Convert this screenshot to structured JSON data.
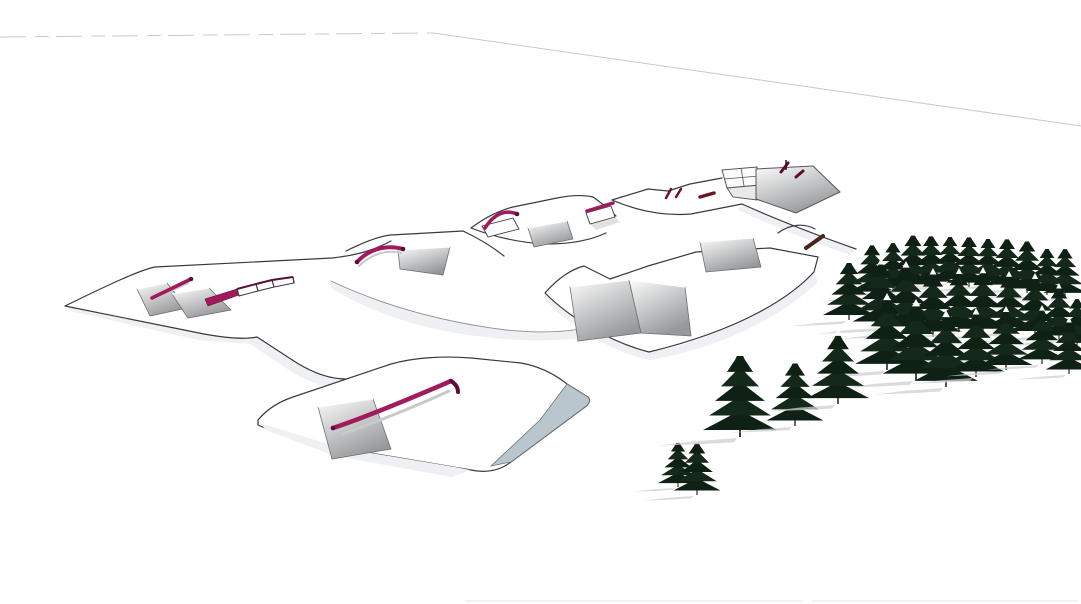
{
  "scene": {
    "kind": "3d-terrain-park-render",
    "canvas": {
      "width": 1081,
      "height": 604
    },
    "palette": {
      "background": "#ffffff",
      "terrain_line": "#3a3a3e",
      "soft_line": "#8f8f94",
      "horizon_line": "#c7cacd",
      "slope_shade": "#eef0f3",
      "ramp_light": "#fcfcfc",
      "ramp_dark": "#96989a",
      "ramp_stroke": "#6f7072",
      "rail_magenta": "#a01a5c",
      "rail_dark": "#5d0c36",
      "rail_shadow": "#c9c9cc",
      "blue_face": "#b9c6ce",
      "blue_face_stroke": "#6b747a",
      "box_white": "#fdfdfd",
      "tree_green": "#14291a",
      "tree_green_dark": "#0f2114",
      "tree_trunk": "#1c1c1c",
      "tree_shadow": "#cfcfd2",
      "jib_red": "#6b1426",
      "brown_rail": "#4b241c",
      "bottom_dash": "#ededef"
    },
    "horizon": {
      "left_segment": "M0,37 L433,33",
      "right_segment": "M433,33 L1081,126",
      "left_dash": "26 9 14 7"
    },
    "bottom_marks": [
      "M465,601 L803,601",
      "M812,601 L1078,601"
    ],
    "shades": [
      {
        "name": "shade-mound1-front",
        "d": "M65,306 L204,334 C232,339 248,339 257,337 L297,363 C315,374 331,379 346,379 L338,388 C318,386 300,378 286,368 L250,344 L198,340 L70,311 Z"
      },
      {
        "name": "shade-central-slope",
        "d": "M331,281 C382,305 442,322 506,330 C546,334 580,332 606,322 L606,334 C560,344 500,342 440,330 C390,320 350,300 331,288 Z"
      },
      {
        "name": "shade-crm-front",
        "d": "M545,293 C570,318 610,342 649,352 C700,345 770,312 814,272 L818,282 C780,318 720,348 650,360 C610,352 570,326 545,300 Z"
      },
      {
        "name": "shade-t4-right",
        "d": "M742,204 C780,221 822,237 856,249 L850,255 C815,243 775,227 738,210 Z"
      }
    ],
    "closed_terrain": [
      {
        "name": "center-right-mound",
        "d": "M545,293 C558,278 572,269 584,266 L610,279 L648,266 L696,252 L770,248 L818,257 L814,272 C790,298 740,330 649,352 C610,342 570,318 545,293 Z"
      },
      {
        "name": "bottom-plateau",
        "d": "M258,420 C268,408 281,401 293,397 L391,364 C416,357 446,356 471,358 L521,363 C543,367 557,376 567,384 L588,397 C591,400 589,404 585,407 L511,462 C499,471 485,473 471,470 L341,448 C301,440 271,431 258,425 Z"
      }
    ],
    "plateau_extras": {
      "blue_face": "M567,384 L588,397 C591,400 589,404 585,407 L511,462 L491,466 L540,420 Z",
      "front_shade": "M260,423 L341,448 L455,467 L470,470 L452,477 L335,456 L266,430 Z"
    },
    "edges": [
      {
        "name": "edge-mound1-back",
        "d": "M65,306 C110,284 140,270 155,267 L332,258 C360,255 376,249 391,241",
        "soft": false
      },
      {
        "name": "edge-mound1-base",
        "d": "M65,306 L204,334 C232,339 248,339 257,337 L297,363 C315,374 331,379 346,379",
        "soft": false
      },
      {
        "name": "edge-t2-back",
        "d": "M346,251 C366,241 380,236 391,235 L463,231",
        "soft": false
      },
      {
        "name": "edge-t2-right",
        "d": "M463,231 C480,239 494,248 504,256",
        "soft": false
      },
      {
        "name": "edge-mid-break",
        "d": "M331,281 C382,305 442,322 506,330 C546,334 580,332 606,322",
        "soft": true
      },
      {
        "name": "edge-t3-back",
        "d": "M471,228 C487,216 501,210 513,207 L557,198 C572,195 584,195 593,197",
        "soft": false
      },
      {
        "name": "edge-t3-right",
        "d": "M593,197 C603,204 611,211 616,216",
        "soft": false
      },
      {
        "name": "edge-t3-front",
        "d": "M471,228 C497,238 522,243 547,244 C572,244 591,240 606,233",
        "soft": false
      },
      {
        "name": "edge-t4-ridge",
        "d": "M612,200 L648,189 L668,191 L690,184 L722,178",
        "soft": false
      },
      {
        "name": "edge-t4-front",
        "d": "M612,200 C640,212 666,216 691,214 L742,204",
        "soft": false
      },
      {
        "name": "edge-t4-right",
        "d": "M742,204 C780,221 822,237 856,249",
        "soft": false
      },
      {
        "name": "edge-behind-trees",
        "d": "M778,233 C790,224 804,223 815,229",
        "soft": false
      }
    ],
    "ramps": [
      {
        "name": "kicker-left-1",
        "points": [
          [
            137,
            289
          ],
          [
            167,
            283
          ],
          [
            187,
            308
          ],
          [
            150,
            316
          ]
        ]
      },
      {
        "name": "kicker-left-2",
        "points": [
          [
            172,
            294
          ],
          [
            209,
            288
          ],
          [
            231,
            310
          ],
          [
            188,
            318
          ]
        ]
      },
      {
        "name": "pit-terrace2",
        "points": [
          [
            398,
            250
          ],
          [
            450,
            247
          ],
          [
            443,
            275
          ],
          [
            400,
            269
          ]
        ]
      },
      {
        "name": "face-terrace3",
        "points": [
          [
            528,
            228
          ],
          [
            567,
            221
          ],
          [
            573,
            239
          ],
          [
            534,
            247
          ]
        ]
      },
      {
        "name": "panel-crm-top",
        "points": [
          [
            700,
            242
          ],
          [
            753,
            238
          ],
          [
            761,
            267
          ],
          [
            706,
            272
          ]
        ]
      },
      {
        "name": "panel-crm-a",
        "points": [
          [
            570,
            287
          ],
          [
            629,
            280
          ],
          [
            641,
            333
          ],
          [
            578,
            341
          ]
        ]
      },
      {
        "name": "panel-crm-b",
        "points": [
          [
            629,
            280
          ],
          [
            685,
            287
          ],
          [
            691,
            336
          ],
          [
            641,
            333
          ]
        ]
      },
      {
        "name": "kicker-plateau",
        "points": [
          [
            318,
            407
          ],
          [
            373,
            399
          ],
          [
            391,
            449
          ],
          [
            332,
            459
          ]
        ]
      }
    ],
    "boxes": [
      {
        "name": "jib-box-1",
        "points": [
          [
            482,
            226
          ],
          [
            513,
            218
          ],
          [
            519,
            229
          ],
          [
            488,
            237
          ]
        ]
      },
      {
        "name": "jib-box-2",
        "points": [
          [
            586,
            213
          ],
          [
            611,
            206
          ],
          [
            615,
            217
          ],
          [
            590,
            224
          ]
        ]
      }
    ],
    "box_shadows": [
      {
        "name": "jib-box-2-shadow",
        "points": [
          [
            590,
            224
          ],
          [
            615,
            217
          ],
          [
            620,
            222
          ],
          [
            596,
            230
          ]
        ]
      }
    ],
    "rail_shadows": [
      {
        "d": "M150,301 L188,283",
        "w": 2
      },
      {
        "d": "M359,266 C370,255 386,249 401,253",
        "w": 2
      },
      {
        "d": "M342,434 C385,419 425,402 449,391",
        "w": 3
      }
    ],
    "rails": [
      {
        "name": "rail-straight-left",
        "d": "M152,298 L191,279",
        "w": 3.5,
        "caps": [
          [
            191,
            279
          ]
        ]
      },
      {
        "name": "rail-rainbow",
        "d": "M357,262 C368,250 385,244 403,249",
        "w": 4,
        "caps": [
          [
            357,
            262
          ],
          [
            403,
            249
          ]
        ]
      },
      {
        "name": "rail-box-1",
        "d": "M485,228 C494,214 505,209 517,214",
        "w": 3.5,
        "caps": [
          [
            517,
            214
          ]
        ]
      },
      {
        "name": "rail-box-2",
        "d": "M587,211 L613,203",
        "w": 3.5,
        "caps": []
      },
      {
        "name": "rail-plateau-long",
        "d": "M333,428 C360,419 400,403 451,381",
        "w": 4.5,
        "caps": [
          [
            333,
            428
          ]
        ]
      },
      {
        "name": "rail-plateau-hook",
        "d": "M451,381 C456,384 458,388 458,392",
        "w": 4,
        "caps": [],
        "dark": true
      }
    ],
    "fence": {
      "solid": [
        [
          205,
          299
        ],
        [
          237,
          289
        ],
        [
          239,
          295
        ],
        [
          208,
          306
        ]
      ],
      "top": [
        [
          237,
          289
        ],
        [
          256,
          284
        ],
        [
          272,
          280
        ],
        [
          293,
          277
        ]
      ],
      "bottom": [
        [
          239,
          296
        ],
        [
          258,
          291
        ],
        [
          274,
          287
        ],
        [
          294,
          283
        ]
      ]
    },
    "funbox": {
      "grid_top": [
        [
          722,
          170
        ],
        [
          757,
          167
        ],
        [
          760,
          185
        ],
        [
          727,
          188
        ]
      ],
      "grid_lines": [
        "M741,168 L744,186",
        "M724,179 L759,176"
      ],
      "front_face": [
        [
          727,
          188
        ],
        [
          760,
          185
        ],
        [
          757,
          200
        ],
        [
          733,
          197
        ]
      ],
      "big_face": [
        [
          756,
          169
        ],
        [
          813,
          166
        ],
        [
          840,
          192
        ],
        [
          796,
          213
        ],
        [
          756,
          199
        ]
      ],
      "jibs": [
        "M781,172 L788,163",
        "M796,177 L803,171"
      ],
      "pin": "M786,160 L786,170"
    },
    "small_jibs": [
      {
        "d": "M666,198 L671,189",
        "w": 2.5
      },
      {
        "d": "M676,197 L681,189",
        "w": 2.5
      },
      {
        "d": "M700,197 L714,193",
        "w": 3.5
      }
    ],
    "brown_rail": {
      "d": "M806,248 L823,236",
      "w": 4
    },
    "trees": {
      "upper": [
        [
          872,
          296,
          55
        ],
        [
          893,
          291,
          52
        ],
        [
          913,
          289,
          58
        ],
        [
          931,
          286,
          54
        ],
        [
          950,
          283,
          50
        ],
        [
          969,
          287,
          54
        ],
        [
          988,
          285,
          50
        ],
        [
          1007,
          289,
          54
        ],
        [
          1027,
          293,
          56
        ],
        [
          1047,
          295,
          50
        ],
        [
          1065,
          297,
          52
        ],
        [
          849,
          320,
          62
        ],
        [
          881,
          327,
          68
        ],
        [
          906,
          332,
          70
        ],
        [
          933,
          337,
          68
        ],
        [
          959,
          332,
          63
        ],
        [
          983,
          334,
          66
        ],
        [
          1009,
          332,
          60
        ],
        [
          1035,
          336,
          62
        ],
        [
          1059,
          340,
          56
        ],
        [
          1077,
          347,
          52
        ],
        [
          887,
          370,
          76
        ],
        [
          916,
          380,
          80
        ],
        [
          946,
          387,
          76
        ],
        [
          976,
          377,
          68
        ],
        [
          1006,
          370,
          63
        ],
        [
          1042,
          364,
          58
        ],
        [
          1069,
          374,
          56
        ]
      ],
      "lower": [
        [
          678,
          487,
          48
        ],
        [
          697,
          495,
          56
        ],
        [
          740,
          437,
          88
        ],
        [
          795,
          426,
          68
        ],
        [
          838,
          404,
          74
        ]
      ]
    }
  }
}
